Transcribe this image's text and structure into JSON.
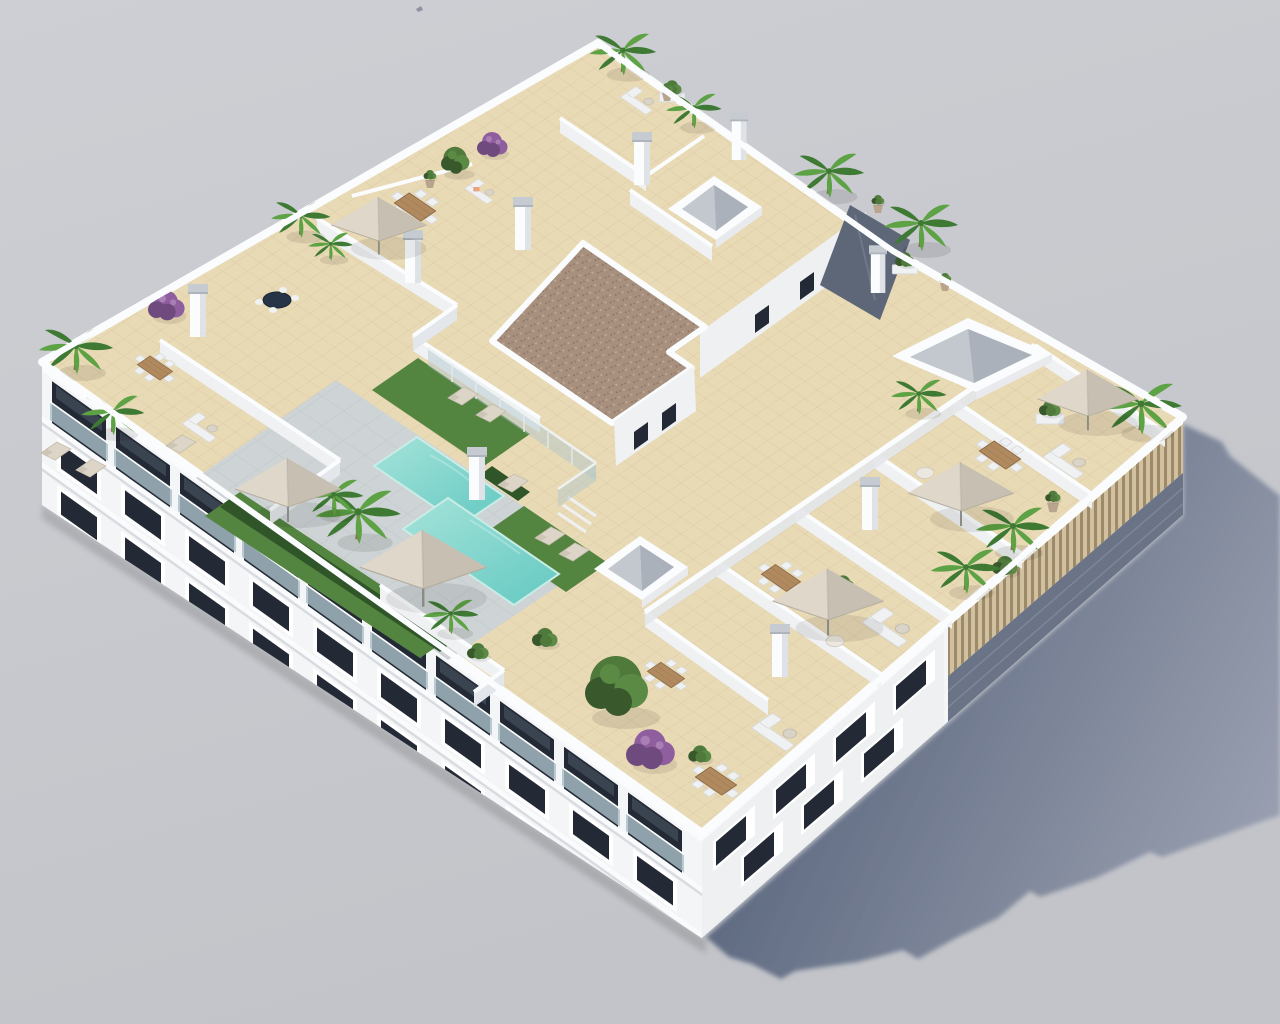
{
  "meta": {
    "description": "3D aerial architectural rendering of a white apartment building with rooftop terraces, swimming pool and garden furniture on a plain grey studio backdrop",
    "view": "isometric aerial view from above, shadow cast to the lower right"
  },
  "palette": {
    "bg1": "#cdcfd4",
    "bg2": "#c2c4c9",
    "shadow1": "#55617a",
    "shadow2": "#7d8699",
    "shadow3": "#9ba1b2",
    "white": "#fbfcfd",
    "wallFace": "#eff1f3",
    "wallFaceDark": "#e3e6ea",
    "wallLine": "#c9cdd2",
    "fac1": "#f4f5f7",
    "fac2": "#eef0f2",
    "parapet": "#fafbfc",
    "winDark": "#232a35",
    "winBack": "#3a4350",
    "glassRail": "#aabfc8",
    "slabShade": "#ccd0d5",
    "tile": "#e9dab6",
    "tileLine": "#dbc9a3",
    "deck": "#ced3d5",
    "deckLine": "#c0c6c9",
    "pool1": "#a5e3da",
    "pool2": "#63c9c1",
    "poolEdge": "#c8ece6",
    "grass": "#538440",
    "grassDark": "#3c652f",
    "hedge": "#2f5528",
    "gravel": "#a8907f",
    "gravelDot": "#8f7566",
    "gravelDot2": "#bfa893",
    "louver": "#d2c1a0",
    "louverDark": "#9d8a68",
    "underLouver": "#6b7486",
    "underLine": "#7e8799",
    "wood": "#b08a5e",
    "woodEdge": "#8f6c46",
    "furn": "#f0f1f2",
    "furnShade": "#d7dadc",
    "umb": "#ded7ca",
    "umbShade": "#c7c0b2",
    "palm1": "#3e7a33",
    "palm2": "#5da244",
    "potC": "#b9a48e",
    "purple1": "#8f5e9e",
    "purple2": "#6f4a7e",
    "tree1": "#4f7a3c",
    "tree2": "#39592c",
    "tree3": "#5b8a45",
    "slate": "#5d6777",
    "navy": "#273447",
    "chimCap": "#c6cbd1",
    "chimShade": "#dfe3e7",
    "orange": "#e8a27c"
  },
  "scene": {
    "objects": [
      "apartment-building",
      "rooftop-terraces",
      "swimming-pool",
      "sun-deck",
      "artificial-grass",
      "parasols",
      "sun-loungers",
      "dining-sets",
      "outdoor-sofas",
      "palm-trees",
      "bougainvillea",
      "skylights",
      "stair-core-gravel-roof",
      "louvered-screen",
      "balconies",
      "ground-shadow",
      "bird"
    ],
    "counts": {
      "parasols": 6,
      "skylights": 3,
      "visible-floors": 3
    }
  }
}
